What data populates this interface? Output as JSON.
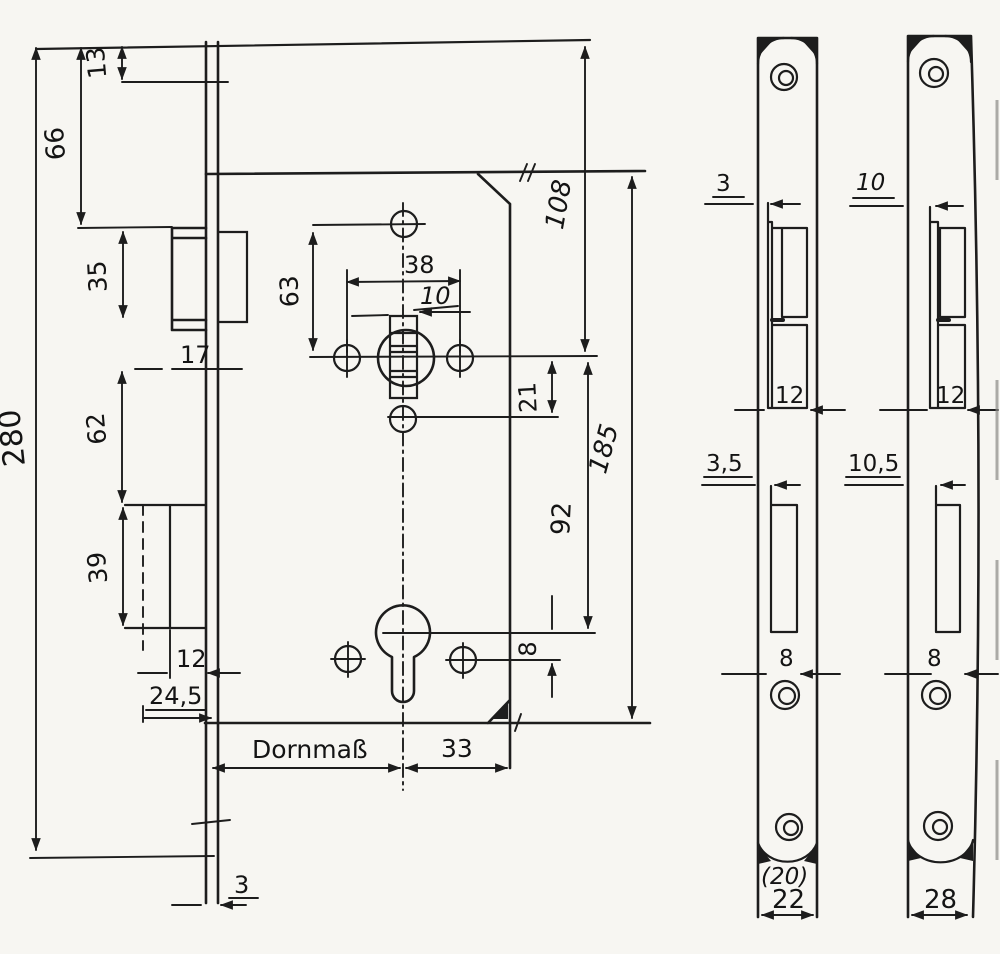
{
  "drawing": {
    "kind": "hand-drawn technical drawing",
    "subject": "mortise lock with two face plates",
    "ink_color": "#1d1d1d",
    "paper_color": "#f7f6f2",
    "main_view": {
      "dims": {
        "overall_height": "280",
        "top_offset": "13",
        "top_to_latch": "66",
        "latch_height": "35",
        "latch_note": "17",
        "latch_to_bolt": "62",
        "bolt_height": "39",
        "bolt_width": "12",
        "bolt_depth": "24,5",
        "plate_thickness": "3",
        "backset_label": "Dornmaß",
        "axis_to_edge": "33",
        "hole_spacing": "38",
        "spindle_square": "10",
        "hole_above_follower": "63",
        "top_to_follower": "108",
        "follower_to_hole": "21",
        "follower_to_cylinder": "92",
        "cylinder_hole_offset": "8",
        "case_height": "185"
      }
    },
    "plate_flat_view": {
      "dims": {
        "latch_step": "3",
        "latch_width": "12",
        "bolt_step": "3,5",
        "bolt_width": "8",
        "width_alt": "(20)",
        "width": "22"
      }
    },
    "plate_round_view": {
      "dims": {
        "latch_step": "10",
        "latch_width": "12",
        "bolt_step": "10,5",
        "bolt_width": "8",
        "width": "28"
      }
    }
  }
}
